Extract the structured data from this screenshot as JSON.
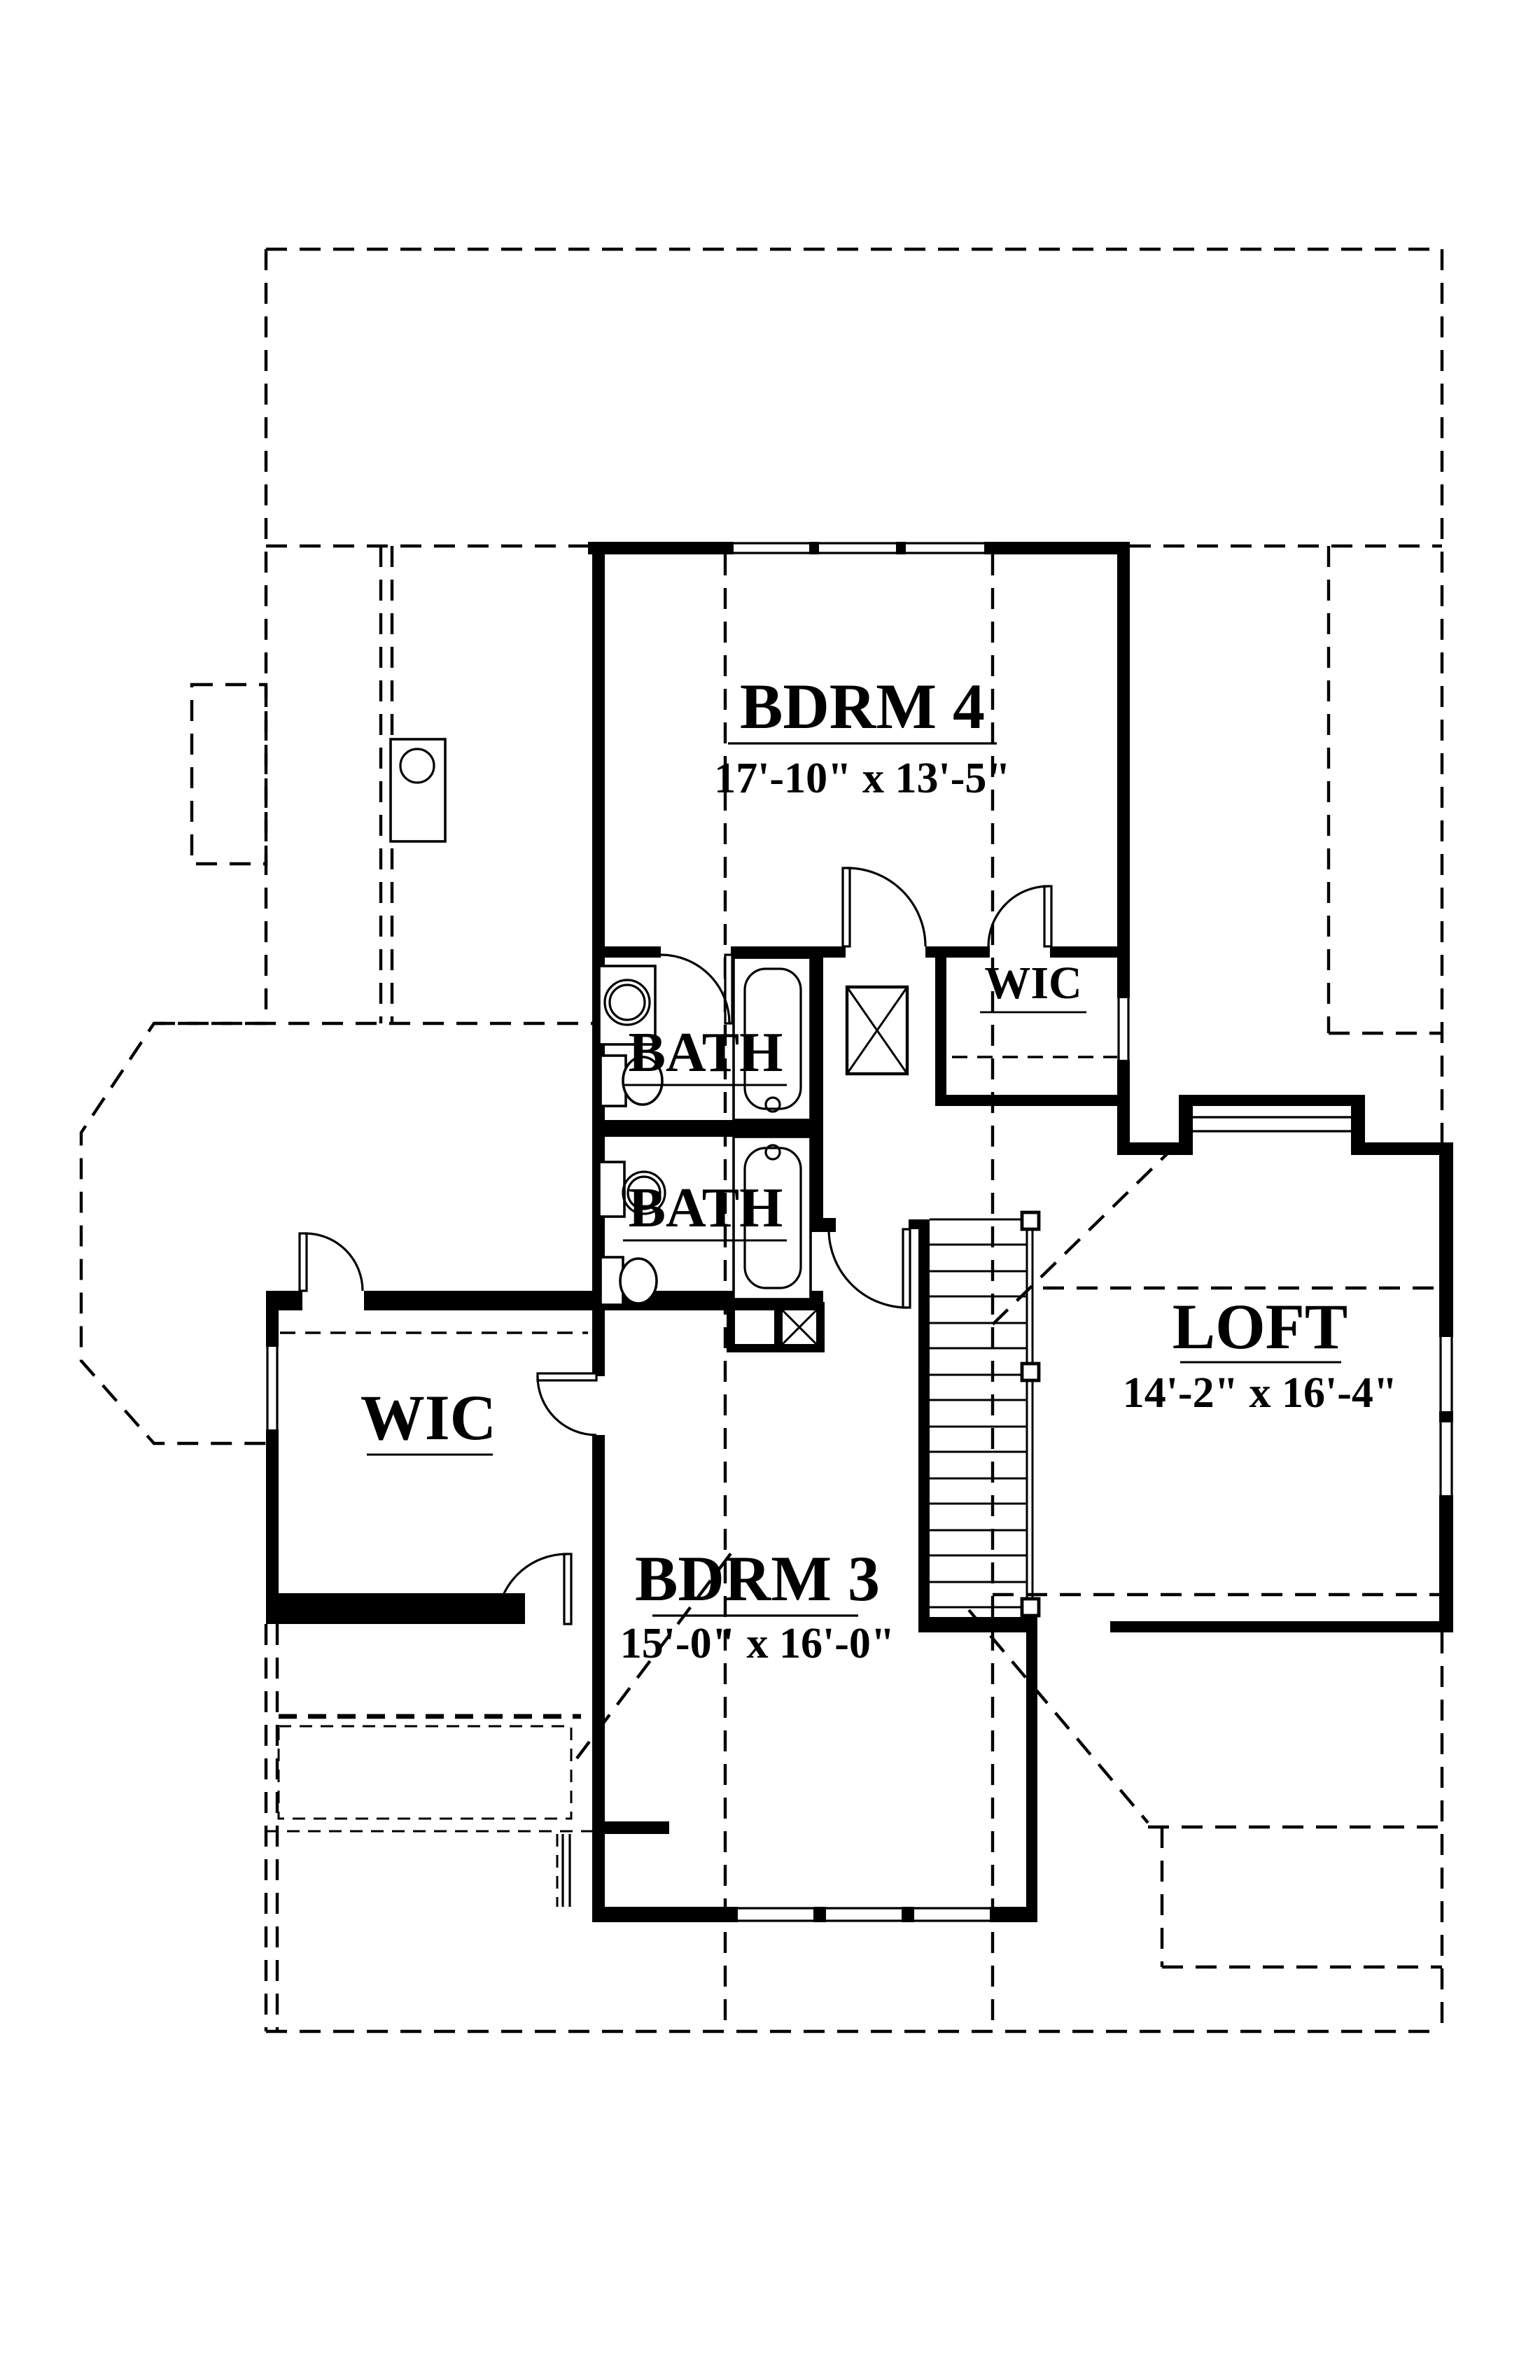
{
  "drawing": {
    "title": "second-floor-plan",
    "colors": {
      "ink": "#000000",
      "paper": "#ffffff"
    },
    "rooms": {
      "bdrm4": {
        "label": "BDRM 4",
        "dims": "17'-10\" x 13'-5\""
      },
      "wic_upper": {
        "label": "WIC"
      },
      "bath_upper": {
        "label": "BATH"
      },
      "bath_lower": {
        "label": "BATH"
      },
      "wic_left": {
        "label": "WIC"
      },
      "loft": {
        "label": "LOFT",
        "dims": "14'-2\" x 16'-4\""
      },
      "bdrm3": {
        "label": "BDRM 3",
        "dims": "15'-0\" x 16'-0\""
      }
    }
  }
}
